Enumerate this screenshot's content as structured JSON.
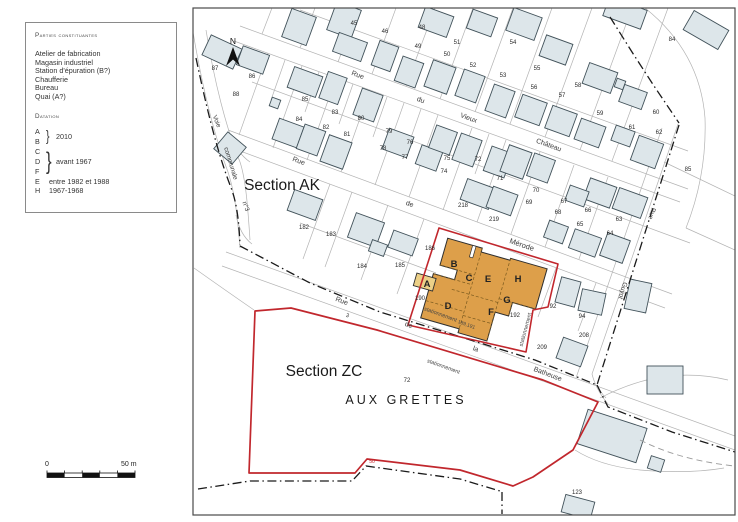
{
  "legend": {
    "title": "Parties constituantes",
    "items": [
      "Atelier de fabrication",
      "Magasin industriel",
      "Station d'épuration (B?)",
      "Chaufferie",
      "Bureau",
      "Quai (A?)"
    ],
    "datation_title": "Datation",
    "group_ab": {
      "l1": "A",
      "l2": "B",
      "value": "2010"
    },
    "group_cdf": {
      "l1": "C",
      "l2": "D",
      "l3": "F",
      "value": "avant 1967"
    },
    "single_e": {
      "letter": "E",
      "value": "entre 1982 et 1988"
    },
    "single_h": {
      "letter": "H",
      "value": "1967-1968"
    }
  },
  "scalebar": {
    "zero": "0",
    "end": "50 m"
  },
  "map": {
    "north_label": "N",
    "sections": [
      {
        "label": "Section AK",
        "x": 282,
        "y": 190
      },
      {
        "label": "Section ZC",
        "x": 324,
        "y": 376
      }
    ],
    "place": {
      "label": "AUX GRETTES",
      "x": 406,
      "y": 404
    },
    "streets": [
      {
        "label": "Rue",
        "x": 357,
        "y": 77,
        "r": 20,
        "s": 7
      },
      {
        "label": "du",
        "x": 420,
        "y": 102,
        "r": 20,
        "s": 7
      },
      {
        "label": "Vieux",
        "x": 468,
        "y": 120,
        "r": 20,
        "s": 7
      },
      {
        "label": "Château",
        "x": 548,
        "y": 147,
        "r": 20,
        "s": 7
      },
      {
        "label": "Rue",
        "x": 298,
        "y": 163,
        "r": 20,
        "s": 7
      },
      {
        "label": "de",
        "x": 409,
        "y": 206,
        "r": 20,
        "s": 7
      },
      {
        "label": "Mérode",
        "x": 521,
        "y": 247,
        "r": 19,
        "s": 7.5
      },
      {
        "label": "Rue",
        "x": 341,
        "y": 303,
        "r": 20,
        "s": 7
      },
      {
        "label": "de",
        "x": 408,
        "y": 327,
        "r": 20,
        "s": 7
      },
      {
        "label": "la",
        "x": 475,
        "y": 351,
        "r": 20,
        "s": 7
      },
      {
        "label": "Batheuse",
        "x": 547,
        "y": 376,
        "r": 21,
        "s": 7
      },
      {
        "label": "Voie",
        "x": 215,
        "y": 122,
        "r": 68,
        "s": 6.5
      },
      {
        "label": "communale",
        "x": 229,
        "y": 164,
        "r": 73,
        "s": 6.5
      },
      {
        "label": "n°3",
        "x": 244,
        "y": 207,
        "r": 70,
        "s": 6.5
      },
      {
        "label": "Rue",
        "x": 650,
        "y": 213,
        "r": 107,
        "s": 6.5
      },
      {
        "label": "Guyot",
        "x": 621,
        "y": 290,
        "r": 107,
        "s": 6.5
      }
    ],
    "parcels": [
      {
        "n": "87",
        "x": 215,
        "y": 70
      },
      {
        "n": "86",
        "x": 252,
        "y": 78
      },
      {
        "n": "88",
        "x": 236,
        "y": 96
      },
      {
        "n": "85",
        "x": 305,
        "y": 101
      },
      {
        "n": "84",
        "x": 299,
        "y": 121
      },
      {
        "n": "83",
        "x": 335,
        "y": 114
      },
      {
        "n": "82",
        "x": 326,
        "y": 129
      },
      {
        "n": "81",
        "x": 347,
        "y": 136
      },
      {
        "n": "80",
        "x": 361,
        "y": 120
      },
      {
        "n": "79",
        "x": 389,
        "y": 133
      },
      {
        "n": "78",
        "x": 383,
        "y": 150
      },
      {
        "n": "77",
        "x": 405,
        "y": 159
      },
      {
        "n": "76",
        "x": 410,
        "y": 144
      },
      {
        "n": "75",
        "x": 447,
        "y": 160
      },
      {
        "n": "74",
        "x": 444,
        "y": 173
      },
      {
        "n": "45",
        "x": 354,
        "y": 25
      },
      {
        "n": "46",
        "x": 385,
        "y": 33
      },
      {
        "n": "48",
        "x": 422,
        "y": 29
      },
      {
        "n": "49",
        "x": 418,
        "y": 48
      },
      {
        "n": "50",
        "x": 447,
        "y": 56
      },
      {
        "n": "51",
        "x": 457,
        "y": 44
      },
      {
        "n": "52",
        "x": 473,
        "y": 67
      },
      {
        "n": "53",
        "x": 503,
        "y": 77
      },
      {
        "n": "54",
        "x": 513,
        "y": 44
      },
      {
        "n": "55",
        "x": 537,
        "y": 70
      },
      {
        "n": "56",
        "x": 534,
        "y": 89
      },
      {
        "n": "57",
        "x": 562,
        "y": 97
      },
      {
        "n": "58",
        "x": 578,
        "y": 87
      },
      {
        "n": "59",
        "x": 600,
        "y": 115
      },
      {
        "n": "60",
        "x": 656,
        "y": 114
      },
      {
        "n": "61",
        "x": 632,
        "y": 129
      },
      {
        "n": "62",
        "x": 659,
        "y": 134
      },
      {
        "n": "84",
        "x": 672,
        "y": 41
      },
      {
        "n": "85",
        "x": 688,
        "y": 171
      },
      {
        "n": "72",
        "x": 478,
        "y": 161
      },
      {
        "n": "71",
        "x": 500,
        "y": 180
      },
      {
        "n": "70",
        "x": 536,
        "y": 192
      },
      {
        "n": "69",
        "x": 529,
        "y": 204
      },
      {
        "n": "67",
        "x": 564,
        "y": 203
      },
      {
        "n": "68",
        "x": 558,
        "y": 214
      },
      {
        "n": "66",
        "x": 588,
        "y": 212
      },
      {
        "n": "65",
        "x": 580,
        "y": 226
      },
      {
        "n": "63",
        "x": 619,
        "y": 221
      },
      {
        "n": "64",
        "x": 610,
        "y": 235
      },
      {
        "n": "218",
        "x": 463,
        "y": 207
      },
      {
        "n": "219",
        "x": 494,
        "y": 221
      },
      {
        "n": "182",
        "x": 304,
        "y": 229
      },
      {
        "n": "183",
        "x": 331,
        "y": 236
      },
      {
        "n": "184",
        "x": 362,
        "y": 268
      },
      {
        "n": "185",
        "x": 400,
        "y": 267
      },
      {
        "n": "186",
        "x": 430,
        "y": 250
      },
      {
        "n": "190",
        "x": 420,
        "y": 300
      },
      {
        "n": "192",
        "x": 515,
        "y": 317
      },
      {
        "n": "92",
        "x": 553,
        "y": 308
      },
      {
        "n": "94",
        "x": 582,
        "y": 318
      },
      {
        "n": "208",
        "x": 584,
        "y": 337
      },
      {
        "n": "209",
        "x": 542,
        "y": 349
      },
      {
        "n": "72",
        "x": 407,
        "y": 382
      },
      {
        "n": "123",
        "x": 577,
        "y": 494
      }
    ],
    "annotations": [
      {
        "label": "stationnement",
        "x": 440,
        "y": 316,
        "r": 20,
        "s": 5.5,
        "c": "#444"
      },
      {
        "label": "189,191",
        "x": 466,
        "y": 326,
        "r": 20,
        "s": 5,
        "c": "#444"
      },
      {
        "label": "stationnement",
        "x": 527,
        "y": 330,
        "r": -75,
        "s": 5.5,
        "c": "#444"
      },
      {
        "label": "stationnement",
        "x": 443,
        "y": 368,
        "r": 20,
        "s": 5.5,
        "c": "#444"
      },
      {
        "label": "3",
        "x": 347,
        "y": 317,
        "r": 20,
        "s": 5.5,
        "c": "#333"
      },
      {
        "label": "50",
        "x": 372,
        "y": 463,
        "r": 0,
        "s": 5,
        "c": "#c1272d"
      }
    ],
    "building_labels": [
      {
        "ch": "A",
        "x": 427,
        "y": 287
      },
      {
        "ch": "B",
        "x": 454,
        "y": 267
      },
      {
        "ch": "C",
        "x": 469,
        "y": 281
      },
      {
        "ch": "D",
        "x": 448,
        "y": 309
      },
      {
        "ch": "E",
        "x": 488,
        "y": 282
      },
      {
        "ch": "F",
        "x": 491,
        "y": 315
      },
      {
        "ch": "G",
        "x": 507,
        "y": 303
      },
      {
        "ch": "H",
        "x": 518,
        "y": 282
      }
    ],
    "buildings": [
      [
        299,
        27,
        26,
        30,
        20
      ],
      [
        344,
        20,
        26,
        30,
        20
      ],
      [
        436,
        22,
        30,
        22,
        20
      ],
      [
        524,
        24,
        30,
        24,
        20
      ],
      [
        625,
        13,
        40,
        20,
        20
      ],
      [
        706,
        30,
        40,
        22,
        30
      ],
      [
        350,
        47,
        30,
        20,
        20
      ],
      [
        385,
        56,
        20,
        26,
        20
      ],
      [
        409,
        72,
        22,
        26,
        20
      ],
      [
        440,
        77,
        24,
        28,
        20
      ],
      [
        482,
        23,
        26,
        20,
        20
      ],
      [
        556,
        50,
        28,
        22,
        20
      ],
      [
        600,
        78,
        30,
        22,
        20
      ],
      [
        470,
        86,
        22,
        28,
        20
      ],
      [
        500,
        101,
        22,
        28,
        20
      ],
      [
        531,
        110,
        26,
        24,
        20
      ],
      [
        561,
        121,
        26,
        24,
        20
      ],
      [
        590,
        133,
        26,
        22,
        20
      ],
      [
        620,
        84,
        9,
        9,
        20
      ],
      [
        633,
        97,
        24,
        18,
        20
      ],
      [
        647,
        152,
        26,
        26,
        20
      ],
      [
        623,
        136,
        20,
        16,
        20
      ],
      [
        222,
        52,
        34,
        22,
        25
      ],
      [
        253,
        60,
        28,
        20,
        20
      ],
      [
        230,
        148,
        24,
        22,
        40
      ],
      [
        275,
        103,
        9,
        9,
        20
      ],
      [
        288,
        133,
        26,
        22,
        20
      ],
      [
        305,
        82,
        30,
        22,
        20
      ],
      [
        333,
        88,
        20,
        28,
        20
      ],
      [
        311,
        140,
        22,
        26,
        20
      ],
      [
        336,
        152,
        24,
        28,
        20
      ],
      [
        368,
        105,
        22,
        28,
        20
      ],
      [
        398,
        143,
        26,
        22,
        20
      ],
      [
        429,
        158,
        22,
        20,
        20
      ],
      [
        443,
        140,
        22,
        24,
        20
      ],
      [
        467,
        150,
        22,
        28,
        20
      ],
      [
        498,
        162,
        22,
        26,
        20
      ],
      [
        516,
        162,
        24,
        28,
        20
      ],
      [
        541,
        168,
        22,
        24,
        20
      ],
      [
        600,
        193,
        28,
        22,
        20
      ],
      [
        585,
        243,
        28,
        20,
        20
      ],
      [
        556,
        232,
        20,
        18,
        20
      ],
      [
        630,
        203,
        30,
        22,
        20
      ],
      [
        615,
        248,
        24,
        24,
        20
      ],
      [
        577,
        196,
        20,
        16,
        20
      ],
      [
        478,
        194,
        30,
        22,
        20
      ],
      [
        502,
        201,
        26,
        22,
        20
      ],
      [
        305,
        205,
        30,
        22,
        20
      ],
      [
        366,
        230,
        30,
        26,
        20
      ],
      [
        378,
        248,
        16,
        12,
        20
      ],
      [
        403,
        243,
        26,
        18,
        20
      ],
      [
        568,
        292,
        20,
        26,
        15
      ],
      [
        638,
        296,
        22,
        30,
        12
      ],
      [
        592,
        302,
        24,
        22,
        12
      ],
      [
        572,
        352,
        26,
        22,
        20
      ],
      [
        665,
        380,
        36,
        28,
        0
      ],
      [
        612,
        436,
        62,
        36,
        18
      ],
      [
        656,
        464,
        14,
        13,
        18
      ],
      [
        578,
        507,
        30,
        18,
        15
      ]
    ],
    "colors": {
      "building_fill": "#dde6ea",
      "building_stroke": "#42525a",
      "industrial_fill": "#dd9f4a",
      "industrial_light": "#ecd087",
      "industrial_line": "#7a5a1e",
      "boundary_red": "#c1272d",
      "commune_dash": "#1a1a1a",
      "parcel_line": "#b3b3b3"
    }
  }
}
